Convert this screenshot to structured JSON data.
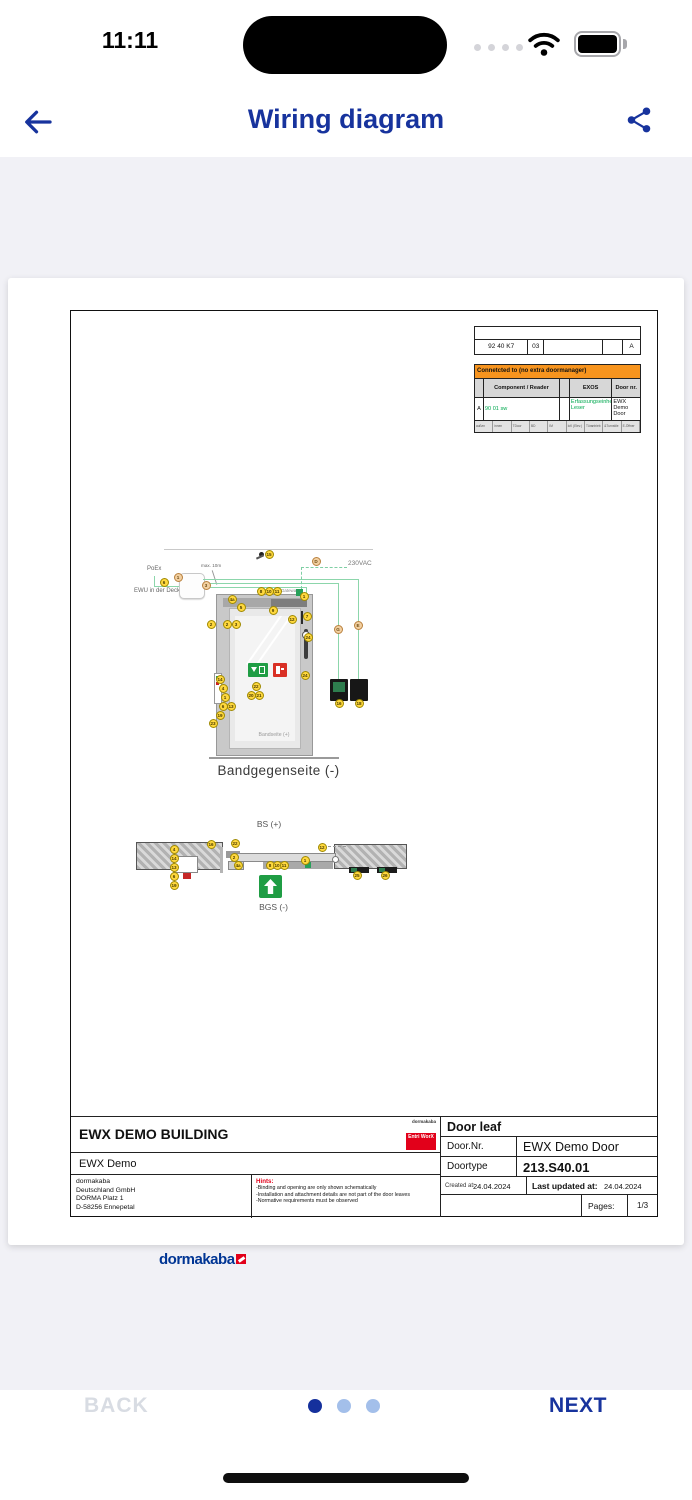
{
  "status_bar": {
    "time": "11:11"
  },
  "header": {
    "title": "Wiring diagram"
  },
  "document": {
    "ref_table": {
      "cells": [
        "92 40 K7",
        "03",
        "",
        "",
        "A"
      ]
    },
    "connect_table": {
      "title": "Connetcted to (no extra doormanager)",
      "col_component": "Component / Reader",
      "col_exos": "EXOS",
      "col_door": "Door nr.",
      "row_index": "A",
      "row_component": "90 01 sw",
      "row_exos": "Erfassungseinheit Leser",
      "row_door": "EWX Demo Door",
      "footer_cells": [
        "außen",
        "innen",
        "TDoor",
        "BD",
        "IM",
        "IcK (Elev.)",
        "Türantrieb",
        "&Turnstile",
        "E-Öffner"
      ]
    },
    "diagram": {
      "labels": {
        "poe": "PoEx",
        "ewu": "EWU in der Decke",
        "max10": "max. 10m",
        "vac": "230VAC",
        "gateway": "Gateway",
        "svp": "SVP-A 1100 (max.50m)",
        "bandseite": "Bandseite (+)",
        "caption": "Bandgegenseite (-)",
        "bs": "BS (+)",
        "bgs": "BGS (-)"
      },
      "markers_vertical": [
        {
          "label": "15",
          "x": 198,
          "y": 243
        },
        {
          "label": "D",
          "x": 245,
          "y": 250,
          "t": "tan"
        },
        {
          "label": "6",
          "x": 93,
          "y": 271
        },
        {
          "label": "1",
          "x": 107,
          "y": 266,
          "t": "tan"
        },
        {
          "label": "3",
          "x": 135,
          "y": 274,
          "t": "tan"
        },
        {
          "label": "4a",
          "x": 161,
          "y": 288
        },
        {
          "label": "5",
          "x": 170,
          "y": 296
        },
        {
          "label": "8",
          "x": 190,
          "y": 280
        },
        {
          "label": "10",
          "x": 198,
          "y": 280
        },
        {
          "label": "11",
          "x": 206,
          "y": 280
        },
        {
          "label": "1",
          "x": 233,
          "y": 285
        },
        {
          "label": "9",
          "x": 202,
          "y": 299
        },
        {
          "label": "12",
          "x": 221,
          "y": 308
        },
        {
          "label": "7",
          "x": 236,
          "y": 305
        },
        {
          "label": "2",
          "x": 140,
          "y": 313
        },
        {
          "label": "2",
          "x": 156,
          "y": 313
        },
        {
          "label": "3",
          "x": 165,
          "y": 313
        },
        {
          "label": "24",
          "x": 237,
          "y": 326
        },
        {
          "label": "24",
          "x": 234,
          "y": 364
        },
        {
          "label": "G",
          "x": 267,
          "y": 318,
          "t": "tan"
        },
        {
          "label": "E",
          "x": 287,
          "y": 314,
          "t": "tan"
        },
        {
          "label": "16",
          "x": 268,
          "y": 392
        },
        {
          "label": "18",
          "x": 288,
          "y": 392
        },
        {
          "label": "14",
          "x": 149,
          "y": 368
        },
        {
          "label": "4",
          "x": 152,
          "y": 377
        },
        {
          "label": "1",
          "x": 154,
          "y": 386
        },
        {
          "label": "6",
          "x": 152,
          "y": 395
        },
        {
          "label": "13",
          "x": 160,
          "y": 395
        },
        {
          "label": "19",
          "x": 149,
          "y": 404
        },
        {
          "label": "23",
          "x": 142,
          "y": 412
        },
        {
          "label": "22",
          "x": 185,
          "y": 375
        },
        {
          "label": "20",
          "x": 180,
          "y": 384
        },
        {
          "label": "21",
          "x": 188,
          "y": 384
        }
      ],
      "markers_section": [
        {
          "label": "4",
          "x": 103,
          "y": 538
        },
        {
          "label": "14",
          "x": 103,
          "y": 547
        },
        {
          "label": "13",
          "x": 103,
          "y": 556
        },
        {
          "label": "6",
          "x": 103,
          "y": 565
        },
        {
          "label": "19",
          "x": 103,
          "y": 574
        },
        {
          "label": "16",
          "x": 140,
          "y": 533
        },
        {
          "label": "22",
          "x": 164,
          "y": 532
        },
        {
          "label": "2",
          "x": 163,
          "y": 546
        },
        {
          "label": "4a",
          "x": 167,
          "y": 554
        },
        {
          "label": "8",
          "x": 199,
          "y": 554
        },
        {
          "label": "10",
          "x": 206,
          "y": 554
        },
        {
          "label": "11",
          "x": 213,
          "y": 554
        },
        {
          "label": "1",
          "x": 234,
          "y": 549
        },
        {
          "label": "12",
          "x": 251,
          "y": 536
        },
        {
          "label": "25",
          "x": 286,
          "y": 564
        },
        {
          "label": "26",
          "x": 314,
          "y": 564
        }
      ]
    },
    "title_block": {
      "building": "EWX DEMO BUILDING",
      "project": "EWX Demo",
      "logo_small_top": "dormakaba",
      "logo_small_red": "Entri WorX",
      "address_lines": [
        "dormakaba",
        "Deutschland GmbH",
        "DORMA Platz 1",
        "D-58256 Ennepetal"
      ],
      "brand": "dormakaba",
      "hints_title": "Hints:",
      "hints": [
        "-Binding and opening are only shown schematically",
        "-Installation and attachment details are not part of the door leaves",
        "-Normative requirements must be observed"
      ],
      "door_leaf": "Door leaf",
      "door_nr_label": "Door.Nr.",
      "door_nr": "EWX Demo Door",
      "doortype_label": "Doortype",
      "doortype": "213.S40.01",
      "created_label": "Created at:",
      "created": "24.04.2024",
      "updated_label": "Last updated at:",
      "updated": "24.04.2024",
      "pages_label": "Pages:",
      "pages": "1/3"
    }
  },
  "footer_nav": {
    "back": "BACK",
    "next": "NEXT",
    "page_dots": {
      "count": 3,
      "active": 0
    }
  },
  "colors": {
    "accent_blue": "#17339d",
    "table_orange": "#f7941e",
    "green_text": "#00a84f",
    "marker_yellow": "#ffd83e",
    "brand_blue": "#003594",
    "brand_red": "#e2001a"
  }
}
